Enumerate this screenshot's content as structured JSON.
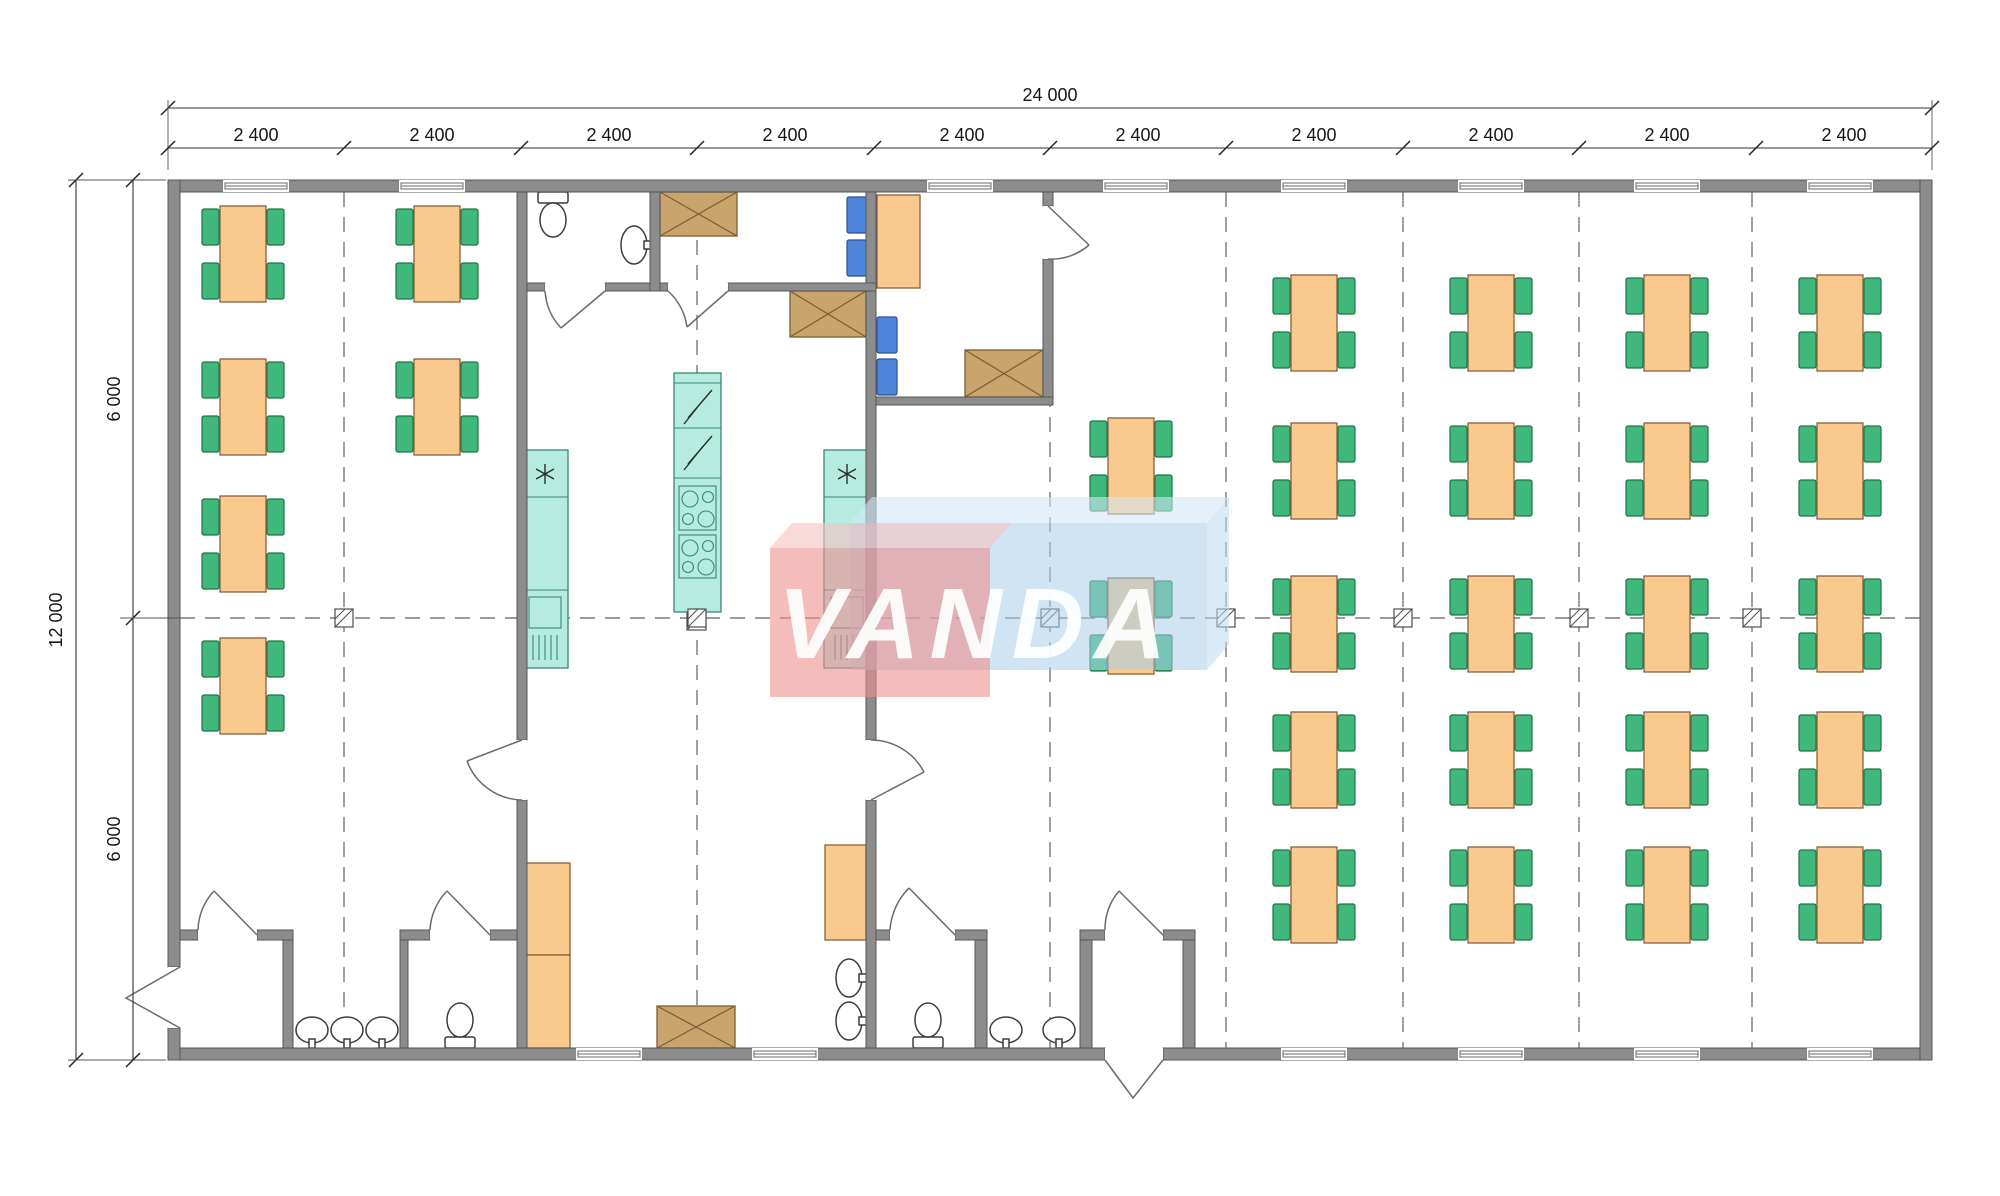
{
  "drawing": {
    "dims": {
      "top": {
        "total": "24 000",
        "segments": [
          "2 400",
          "2 400",
          "2 400",
          "2 400",
          "2 400",
          "2 400",
          "2 400",
          "2 400",
          "2 400",
          "2 400"
        ]
      },
      "left": {
        "total": "12 000",
        "segments": [
          "6 000",
          "6 000"
        ]
      }
    },
    "watermark": {
      "text": "VANDA"
    }
  },
  "colors": {
    "wall": "#8c8c8c",
    "wall_edge": "#565656",
    "table": "#f9c98e",
    "table_edge": "#86613a",
    "chair": "#41b87b",
    "chair_edge": "#1d7448",
    "chair_blue": "#4f86db",
    "chair_blue_edge": "#2a4f96",
    "teal": "#b5ecdf",
    "teal_edge": "#35877a",
    "tan": "#c9a46c",
    "tan_edge": "#7a5c33",
    "line": "#787878",
    "dim": "#161616",
    "fixture_edge": "#3c3c3c",
    "watermark_red": "#ee8f8f",
    "watermark_red_top": "#f6c3c3",
    "watermark_blue": "#a9cdea",
    "watermark_blue_top": "#d3e7f6",
    "watermark_blue_side": "#bcd9f0",
    "watermark_text": "#ffffff"
  }
}
